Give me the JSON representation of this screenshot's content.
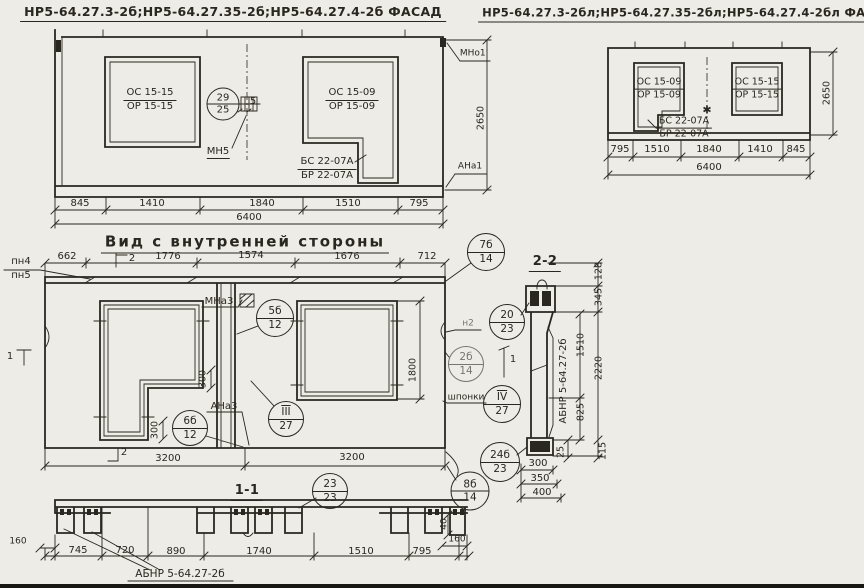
{
  "meta": {
    "paper_color": "#eeece6",
    "ink_color": "#2a2620"
  },
  "facade_left": {
    "title": "НР5-64.27.3-2б;НР5-64.27.35-2б;НР5-64.27.4-2б ФАСАД",
    "window1_top": "ОС 15-15",
    "window1_bot": "ОР 15-15",
    "window2_top": "ОС 15-09",
    "window2_bot": "ОР 15-09",
    "beam_top": "БС 22-07А",
    "beam_bot": "БР 22-07А",
    "circle29": [
      "29",
      "25"
    ],
    "anchor_num": "5",
    "anchor_label": "МН5",
    "mark_top_right": "МНо1'",
    "mark_bot_right": "АНа1",
    "dim_height": "2650",
    "dims_bottom": [
      "845",
      "1410",
      "1840",
      "1510",
      "795"
    ],
    "dim_total": "6400"
  },
  "facade_right": {
    "title": "НР5-64.27.3-2бл;НР5-64.27.35-2бл;НР5-64.27.4-2бл ФАСАД",
    "window1_top": "ОС 15-09",
    "window1_bot": "ОР 15-09",
    "window2_top": "ОС 15-15",
    "window2_bot": "ОР 15-15",
    "beam_top": "БС 22-07А",
    "beam_bot": "БР 22-07А",
    "star_mark": "✱",
    "dims_bottom": [
      "795",
      "1510",
      "1840",
      "1410",
      "845"
    ],
    "dim_total": "6400",
    "dim_height": "2650"
  },
  "interior": {
    "title": "Вид с внутренней стороны",
    "edge_top": "пн4",
    "edge_bot": "пн5",
    "dims_top": [
      "662",
      "1776",
      "1574",
      "1676",
      "712"
    ],
    "dims_bottom": [
      "3200",
      "3200"
    ],
    "dim_window": "1800",
    "dim_step_a": "300",
    "dim_step_b": "300",
    "sec2": "2",
    "sec1": "1",
    "anchor_label": "МНа3",
    "corner_label": "АНа3",
    "edge_label": "н2",
    "keys_label": "шпонки",
    "c5b": [
      "5б",
      "12"
    ],
    "c7b": [
      "7б",
      "14"
    ],
    "c2b": [
      "2б",
      "14"
    ],
    "c6b": [
      "6б",
      "12"
    ],
    "cIII": [
      "III",
      "27"
    ],
    "cIV": [
      "IV",
      "27"
    ]
  },
  "section22": {
    "title": "2-2",
    "part_label": "АБНР 5-64.27-2б",
    "dim_128": "128",
    "dim_345": "345",
    "dim_1510": "1510",
    "dim_2220": "2220",
    "dim_825": "825",
    "dim_25": "25",
    "dim_115": "115",
    "dims_bottom": [
      "300",
      "350",
      "400"
    ],
    "c20": [
      "20",
      "23"
    ],
    "c24": [
      "24б",
      "23"
    ]
  },
  "section11": {
    "title": "1-1",
    "part_label": "АБНР 5-64.27-2б",
    "dim_160_left": "160",
    "dims": [
      "745",
      "720",
      "890",
      "1740",
      "1510",
      "795"
    ],
    "dim_40": "40",
    "dim_160_right": "160",
    "c23": [
      "23",
      "23"
    ],
    "c8": [
      "8б",
      "14"
    ]
  }
}
